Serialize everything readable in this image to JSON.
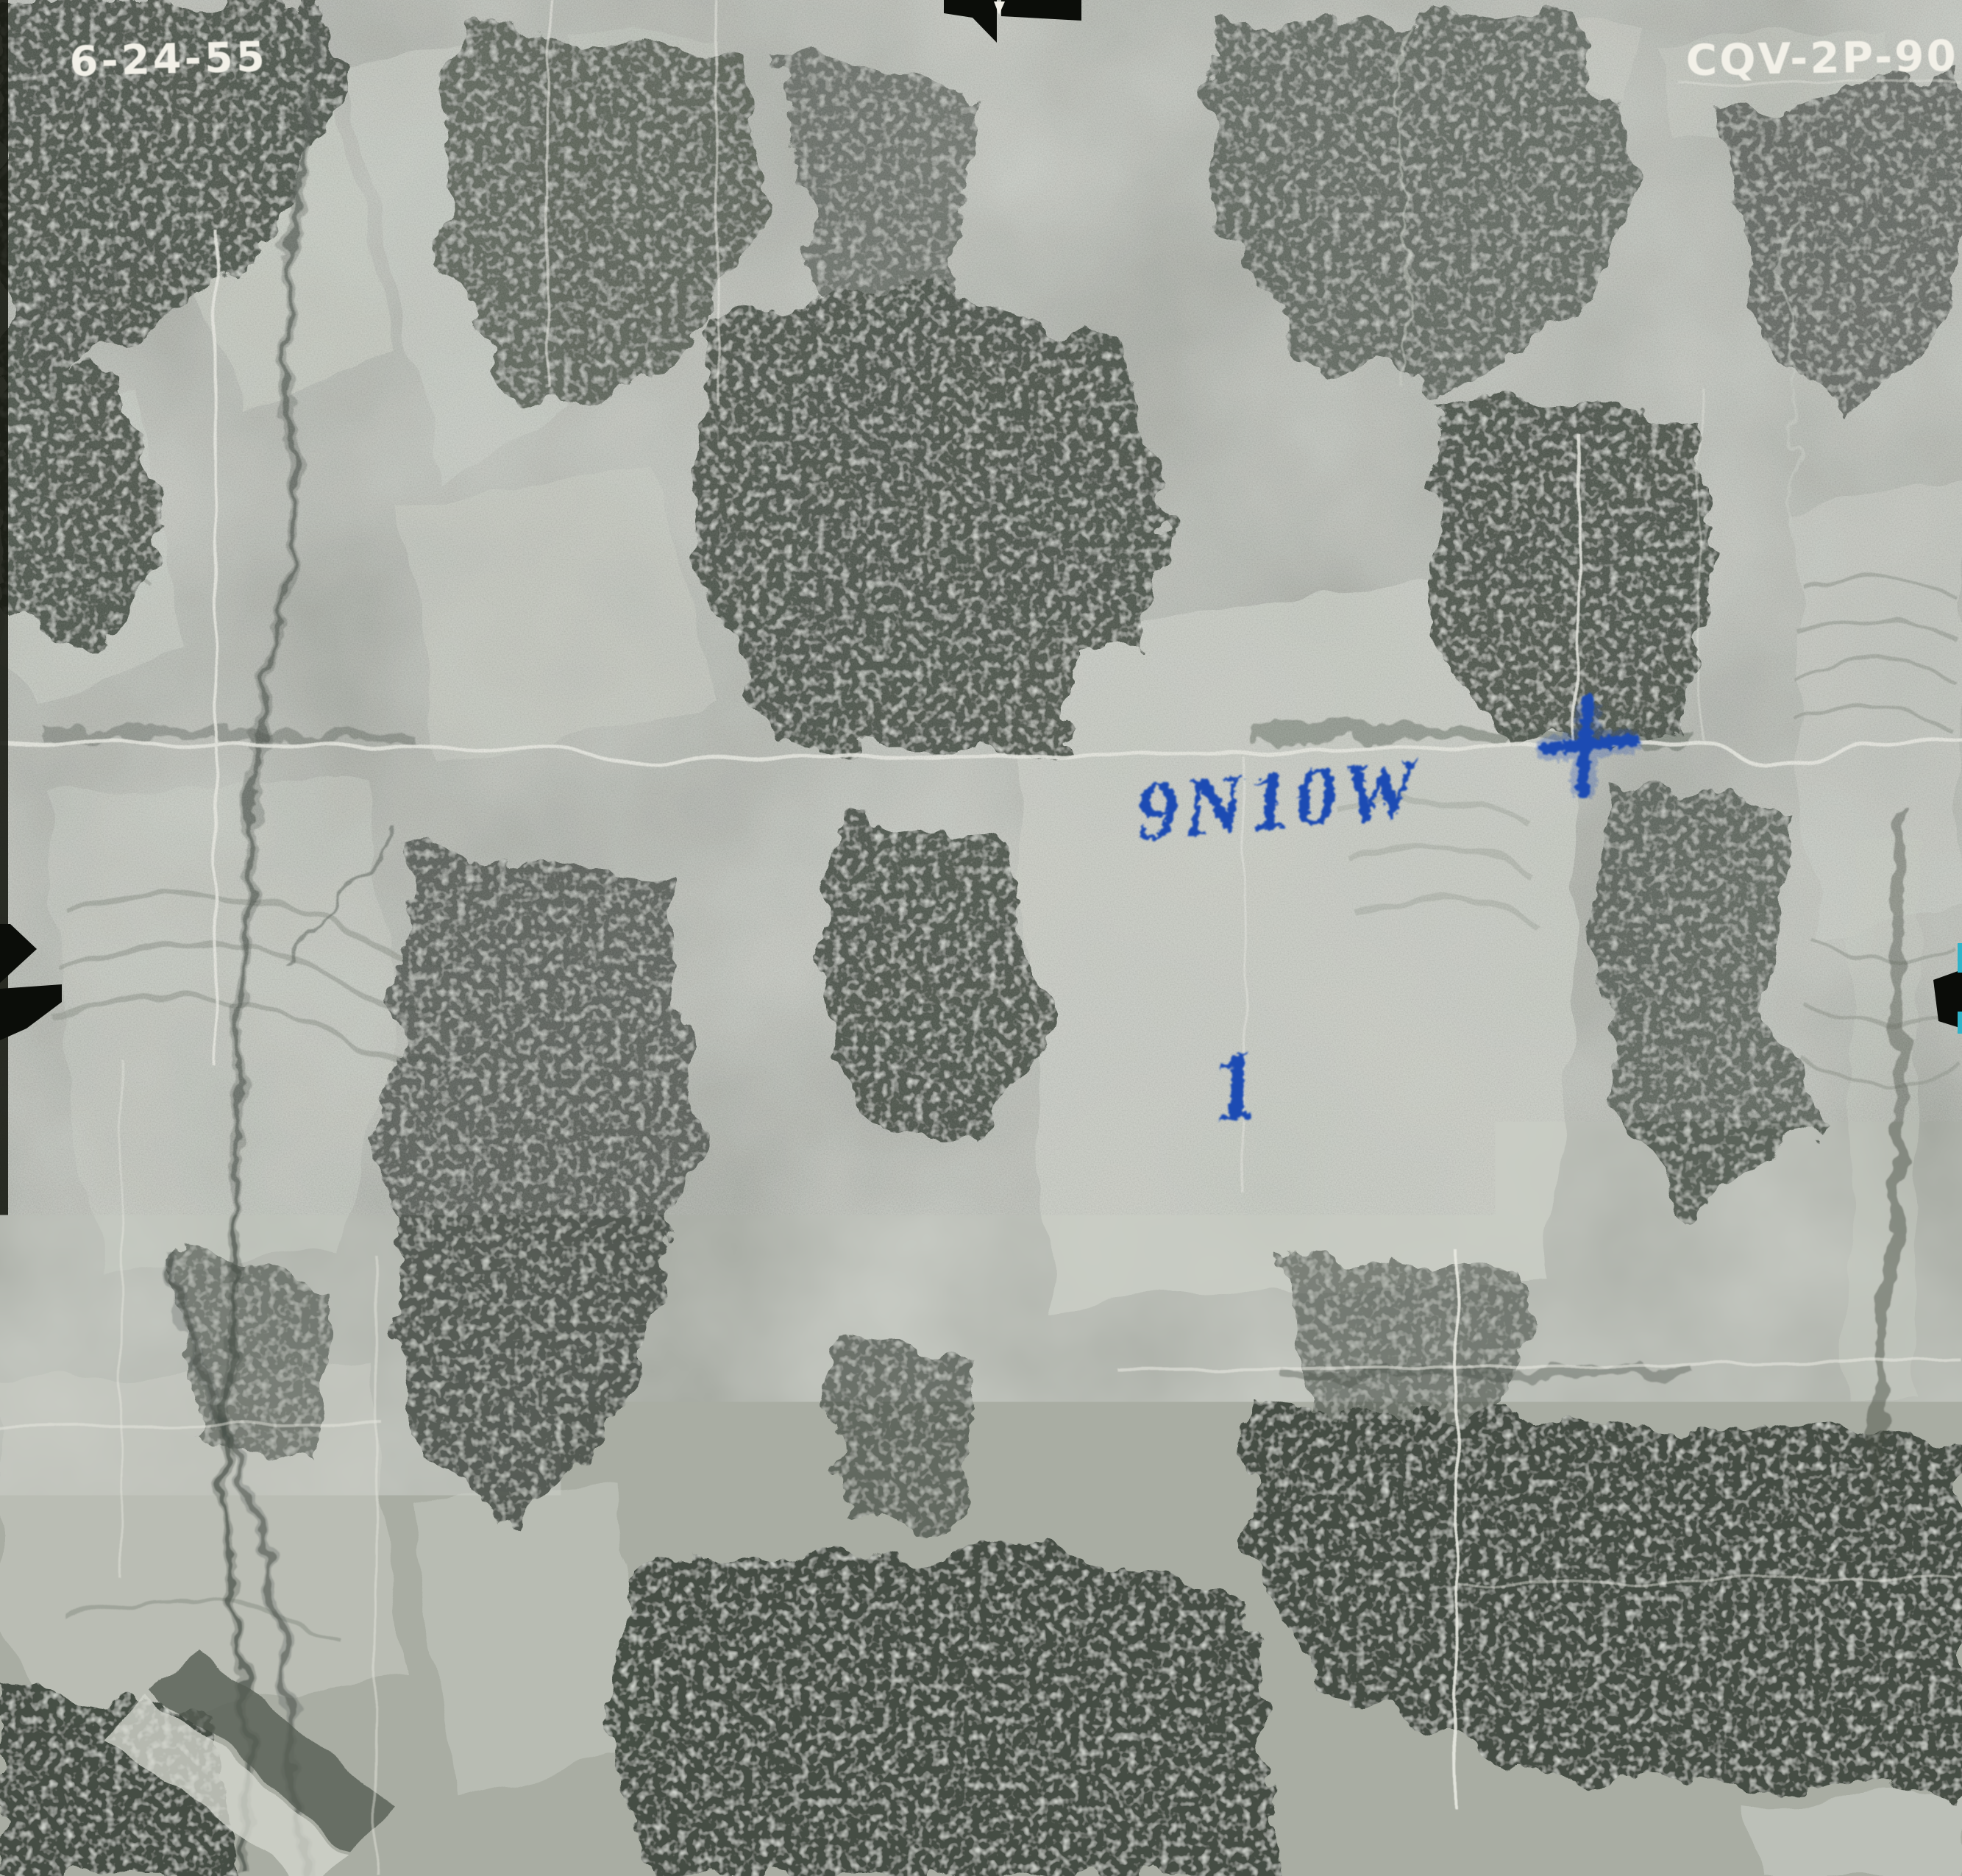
{
  "photo": {
    "date_label": "6-24-55",
    "id_label": "CQV-2P-90",
    "annotations": {
      "township_range": "9N10W",
      "section_number": "1",
      "cross_mark": "+"
    },
    "colors": {
      "annotation_blue": "#1e4cb3",
      "label_white": "#f2f0e8",
      "fiducial_black": "#0b0d09",
      "film_base_gray": "#a9ada3",
      "field_light": "#cbcfc6",
      "forest_dark": "#3c443b",
      "road_white": "#e9eae2",
      "scan_edge_cyan": "#2fb3c9"
    }
  }
}
